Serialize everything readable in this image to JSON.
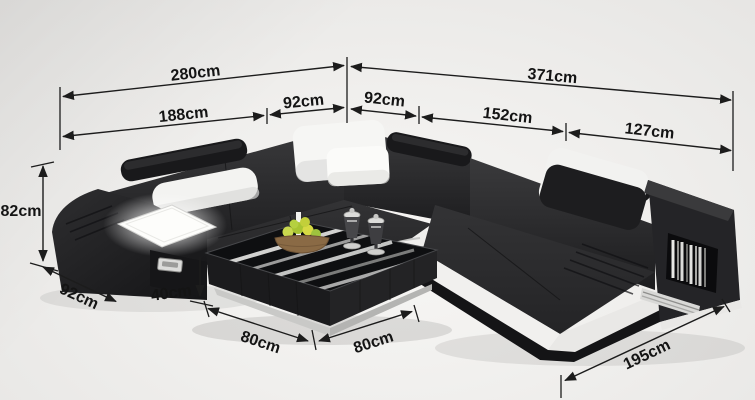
{
  "diagram": {
    "type": "product-dimension-diagram",
    "subject": "U-shaped leather sectional sofa with chaise and coffee table",
    "unit": "cm"
  },
  "dimensions": {
    "top_left_total": "280cm",
    "top_right_total": "371cm",
    "left_section_width": "188cm",
    "corner_left_width": "92cm",
    "corner_right_width": "92cm",
    "right_section_width": "152cm",
    "chaise_back_width": "127cm",
    "back_height": "82cm",
    "arm_depth": "92cm",
    "table_height": "40cm",
    "table_side_left": "80cm",
    "table_side_right": "80cm",
    "chaise_length": "195cm"
  },
  "colors": {
    "annotation": "#1c1c1c",
    "sofa_leather": "#28282a",
    "accent_white": "#f2f1ef",
    "background": "#f0efed",
    "led_panel": "#fdfdfb",
    "fruit_green": "#b6cc3e",
    "basket_brown": "#8a6a45"
  }
}
